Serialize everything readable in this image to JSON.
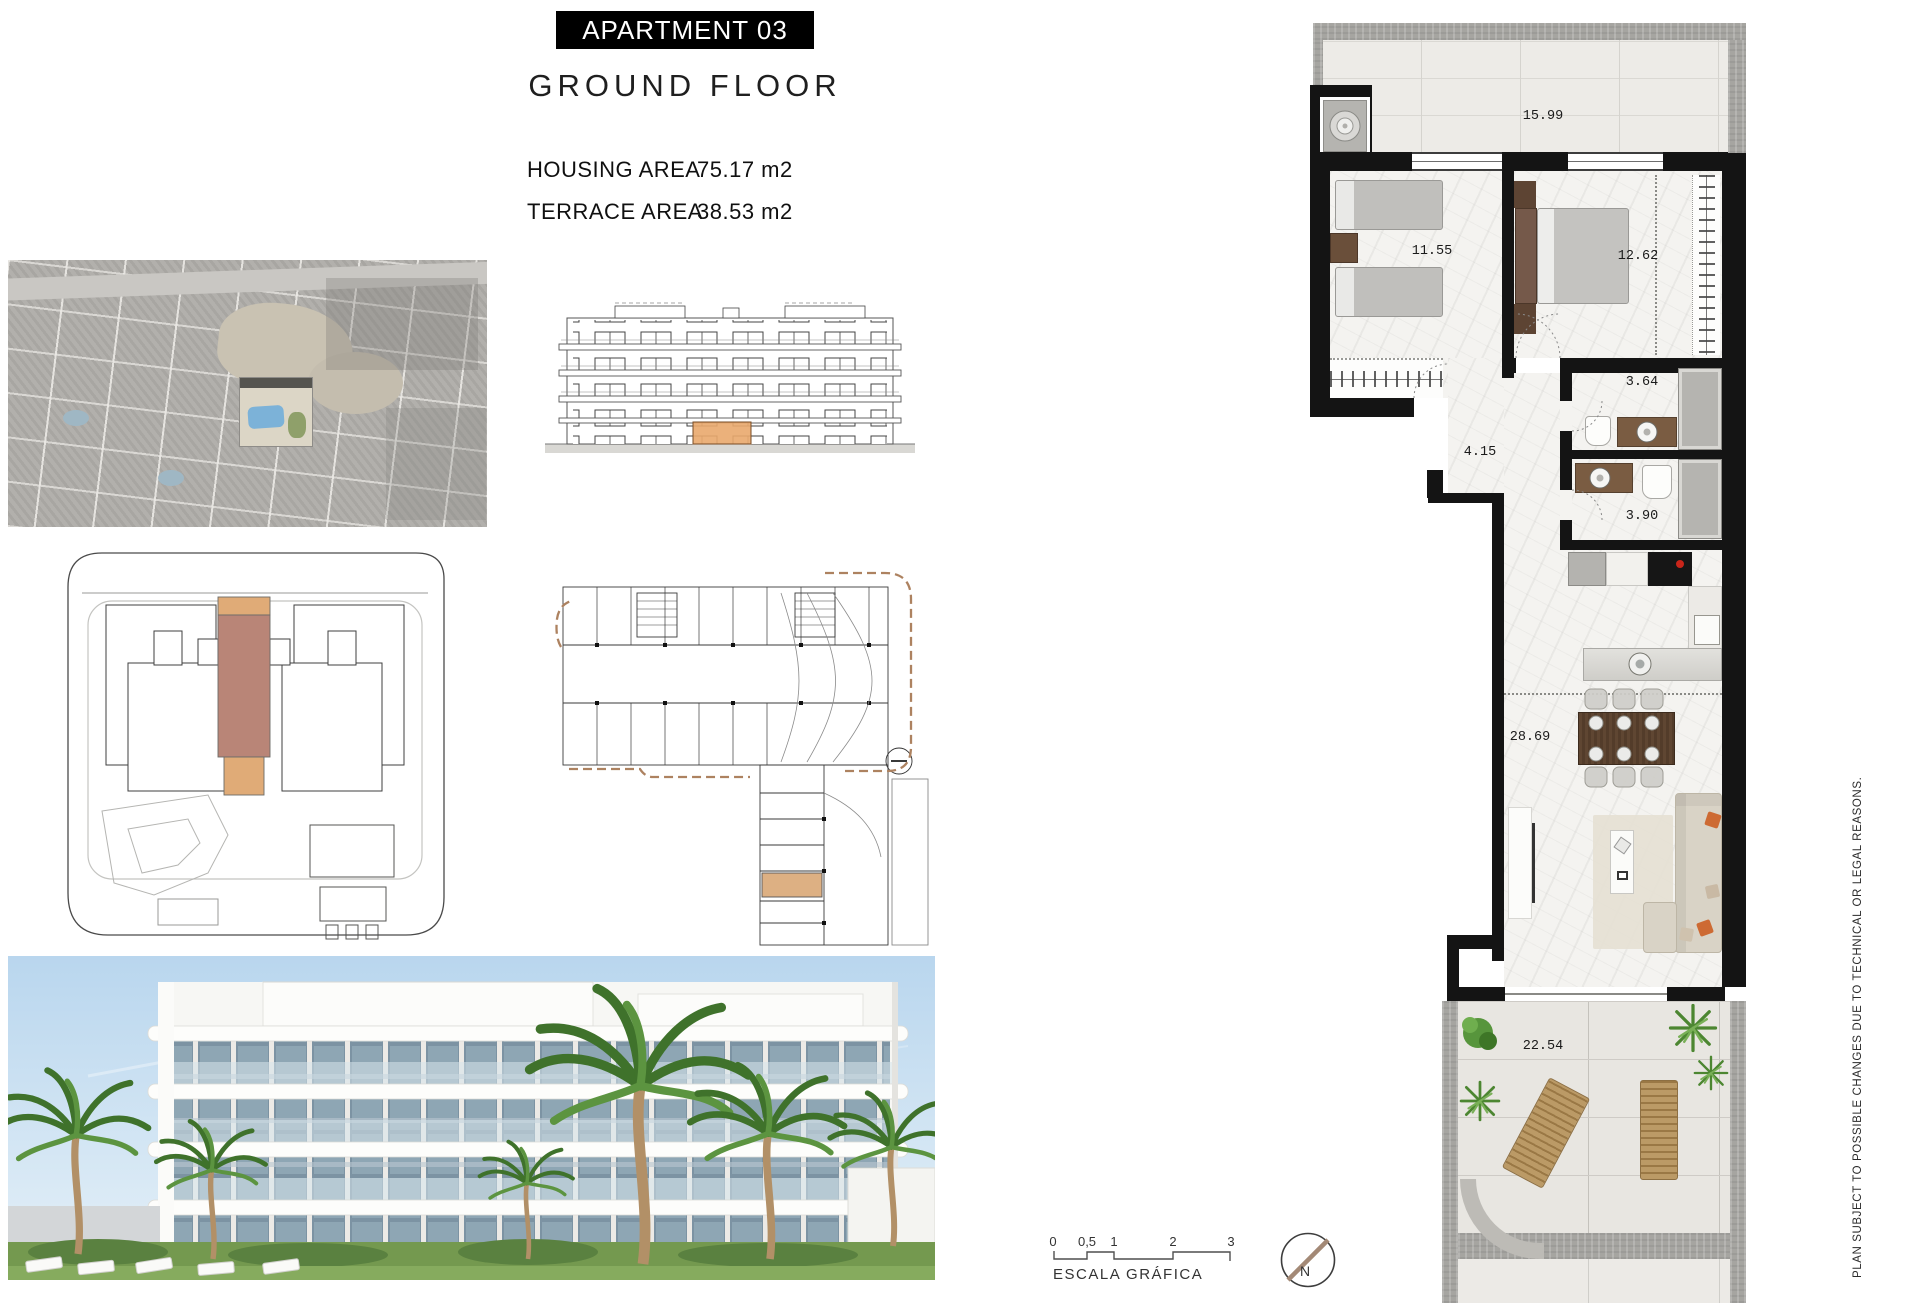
{
  "header": {
    "title": "APARTMENT 03",
    "subtitle": "GROUND FLOOR",
    "housing_area": {
      "label": "HOUSING AREA",
      "value": "75.17 m2"
    },
    "terrace_area": {
      "label": "TERRACE AREA",
      "value": "38.53 m2"
    }
  },
  "plan": {
    "rooms": [
      {
        "name": "upper-terrace",
        "area": "15.99"
      },
      {
        "name": "bedroom-1",
        "area": "11.55"
      },
      {
        "name": "bedroom-2",
        "area": "12.62"
      },
      {
        "name": "bathroom-1",
        "area": "3.64"
      },
      {
        "name": "hallway",
        "area": "4.15"
      },
      {
        "name": "bathroom-2",
        "area": "3.90"
      },
      {
        "name": "living-dining-kitchen",
        "area": "28.69"
      },
      {
        "name": "terrace",
        "area": "22.54"
      }
    ]
  },
  "scale_bar": {
    "label": "ESCALA GRÁFICA",
    "ticks": [
      "0",
      "0,5",
      "1",
      "2",
      "3"
    ]
  },
  "compass": {
    "label": "N"
  },
  "disclaimer": "PLAN SUBJECT TO POSSIBLE CHANGES DUE TO TECHNICAL OR LEGAL REASONS.",
  "colors": {
    "highlight_orange": "#e0ab77",
    "highlight_terracotta": "#b98577",
    "wall_black": "#141414",
    "concrete_gray": "#a6a5a1",
    "pillow_orange": "#cd6a33",
    "hob_red": "#c8251a",
    "plant_green": "#4c8631",
    "sky_blue": "#b9d6ee"
  }
}
